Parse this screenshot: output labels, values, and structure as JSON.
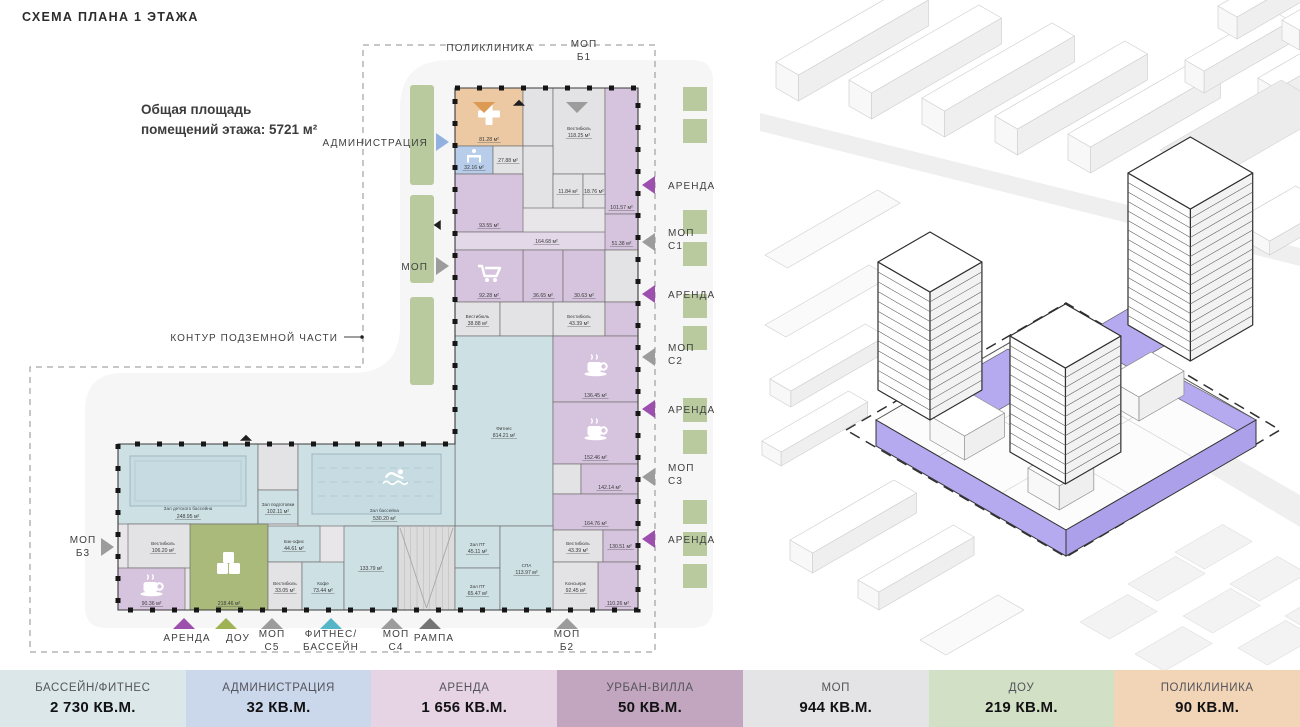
{
  "header": {
    "title": "СХЕМА ПЛАНА 1 ЭТАЖА"
  },
  "annotation": {
    "line1": "Общая площадь",
    "line2": "помещений этажа: 5721 м²"
  },
  "colors": {
    "plot": "#f6f6f6",
    "greenery": "#b9ca9e",
    "wall": "#3a3a3a",
    "rent": "#d6c4de",
    "rentc": "#e2d8e8",
    "mop": "#e3e2e4",
    "pool": "#cde0e4",
    "pool_water": "#c6dce2",
    "clinic": "#ecc9a2",
    "admin": "#b7cde9",
    "dou": "#a9ba7b",
    "ramp": "#dcdcdc",
    "iso_highlight": "#b5a9ef",
    "iso_highlight_dark": "#aca0ea",
    "arrow_orange": "#dc9a52",
    "arrow_gray": "#9c9c9c",
    "arrow_darkgray": "#757575",
    "arrow_purple": "#9d4fae",
    "arrow_blue": "#93b1e0",
    "arrow_green": "#9fb355",
    "arrow_teal": "#55b6c8",
    "arrow_black": "#1f1f1f"
  },
  "plan": {
    "contour": {
      "label": "КОНТУР ПОДЗЕМНОЙ ЧАСТИ",
      "tx": 338,
      "ty": 341,
      "line": [
        344,
        337,
        360,
        337
      ],
      "dot": [
        362,
        337
      ]
    },
    "rooms": [
      {
        "cat": "clinic",
        "r": [
          455,
          88,
          68,
          58
        ],
        "icon": "cross",
        "area": "81.28 м²"
      },
      {
        "cat": "mop",
        "r": [
          523,
          88,
          30,
          58
        ]
      },
      {
        "cat": "mop",
        "r": [
          553,
          88,
          52,
          86
        ],
        "name": "Вестибюль",
        "area": "118.25 м²"
      },
      {
        "cat": "rent",
        "r": [
          605,
          88,
          33,
          126
        ],
        "icon": "ruble",
        "area": "101.57 м²"
      },
      {
        "cat": "admin",
        "r": [
          455,
          146,
          38,
          28
        ],
        "icon": "desk",
        "area": "32.16 м²"
      },
      {
        "cat": "mop",
        "r": [
          493,
          146,
          30,
          28
        ],
        "area": "27.88 м²"
      },
      {
        "cat": "mop",
        "r": [
          523,
          146,
          30,
          62
        ]
      },
      {
        "cat": "mop",
        "r": [
          553,
          174,
          30,
          34
        ],
        "area": "11.84 м²"
      },
      {
        "cat": "mop",
        "r": [
          583,
          174,
          22,
          34
        ],
        "area": "18.76 м²"
      },
      {
        "cat": "rent",
        "r": [
          455,
          174,
          68,
          58
        ],
        "icon": "ruble",
        "area": "93.55 м²"
      },
      {
        "cat": "rentc",
        "r": [
          455,
          232,
          183,
          18
        ],
        "area": "164.68 м²"
      },
      {
        "cat": "rent",
        "r": [
          523,
          250,
          40,
          52
        ],
        "icon": "ruble",
        "area": "36.65 м²"
      },
      {
        "cat": "rent",
        "r": [
          563,
          250,
          42,
          52
        ],
        "icon": "ruble",
        "area": "30.63 м²"
      },
      {
        "cat": "rent",
        "r": [
          605,
          214,
          33,
          36
        ],
        "icon": "ruble",
        "area": "51.38 м²"
      },
      {
        "cat": "mop",
        "r": [
          605,
          250,
          33,
          52
        ]
      },
      {
        "cat": "rent",
        "r": [
          455,
          250,
          68,
          52
        ],
        "icon": "cart",
        "area": "92.28 м²"
      },
      {
        "cat": "mop",
        "r": [
          553,
          302,
          52,
          34
        ],
        "name": "Вестибюль",
        "area": "43.39 м²"
      },
      {
        "cat": "rent",
        "r": [
          605,
          302,
          33,
          34
        ]
      },
      {
        "cat": "mop",
        "r": [
          455,
          302,
          45,
          34
        ],
        "name": "Вестибюль",
        "area": "38.88 м²"
      },
      {
        "cat": "mop",
        "r": [
          500,
          302,
          53,
          34
        ]
      },
      {
        "cat": "pool",
        "r": [
          455,
          336,
          98,
          190
        ],
        "name": "Фитнес",
        "area": "814.21 м²"
      },
      {
        "cat": "rent",
        "r": [
          553,
          336,
          85,
          66
        ],
        "icon": "coffee",
        "area": "136.45 м²"
      },
      {
        "cat": "rent",
        "r": [
          553,
          402,
          85,
          62
        ],
        "icon": "coffee",
        "area": "152.46 м²"
      },
      {
        "cat": "mop",
        "r": [
          553,
          464,
          28,
          30
        ]
      },
      {
        "cat": "rent",
        "r": [
          581,
          464,
          57,
          30
        ],
        "icon": "ruble",
        "area": "142.14 м²"
      },
      {
        "cat": "rent",
        "r": [
          553,
          494,
          85,
          36
        ],
        "icon": "ruble",
        "area": "164.76 м²"
      },
      {
        "cat": "mop",
        "r": [
          553,
          530,
          50,
          32
        ],
        "name": "Вестибюль",
        "area": "43.39 м²"
      },
      {
        "cat": "rent",
        "r": [
          603,
          530,
          35,
          32
        ],
        "area": "130.51 м²"
      },
      {
        "cat": "rent",
        "r": [
          598,
          562,
          40,
          48
        ],
        "icon": "ruble",
        "area": "110.26 м²"
      },
      {
        "cat": "mop",
        "r": [
          553,
          562,
          45,
          48
        ],
        "name": "Консьерж",
        "area": "92.45 м²"
      },
      {
        "cat": "pool",
        "r": [
          118,
          444,
          140,
          80
        ],
        "name": "Зал детского бассейна",
        "area": "248.95 м²",
        "feature": "kidspool"
      },
      {
        "cat": "mop",
        "r": [
          258,
          444,
          40,
          46
        ]
      },
      {
        "cat": "pool",
        "r": [
          258,
          490,
          40,
          34
        ],
        "name": "Зал подготовки",
        "area": "102.11 м²"
      },
      {
        "cat": "pool",
        "r": [
          298,
          444,
          157,
          82
        ],
        "name": "Зал бассейна",
        "area": "530.20 м²",
        "feature": "pool"
      },
      {
        "cat": "mop",
        "r": [
          128,
          524,
          70,
          44
        ],
        "name": "Вестибюль",
        "area": "106.20 м²"
      },
      {
        "cat": "rent",
        "r": [
          118,
          568,
          67,
          42
        ],
        "icon": "coffee",
        "area": "90.36 м²"
      },
      {
        "cat": "dou",
        "r": [
          190,
          524,
          78,
          86
        ],
        "icon": "blocks",
        "area": "218.46 м²"
      },
      {
        "cat": "pool",
        "r": [
          268,
          526,
          52,
          36
        ],
        "name": "Бэк-офис",
        "area": "44.61 м²"
      },
      {
        "cat": "mop",
        "r": [
          268,
          562,
          34,
          48
        ],
        "name": "Вестибюль",
        "area": "33.05 м²"
      },
      {
        "cat": "pool",
        "r": [
          302,
          562,
          42,
          48
        ],
        "name": "Кофе",
        "area": "73.44 м²"
      },
      {
        "cat": "pool",
        "r": [
          344,
          526,
          54,
          84
        ],
        "area": "133.79 м²"
      },
      {
        "cat": "ramp",
        "r": [
          398,
          526,
          57,
          84
        ],
        "feature": "ramp"
      },
      {
        "cat": "pool",
        "r": [
          455,
          526,
          45,
          42
        ],
        "name": "Зал ПТ",
        "area": "45.11 м²"
      },
      {
        "cat": "pool",
        "r": [
          455,
          568,
          45,
          42
        ],
        "name": "Зал ПТ",
        "area": "65.47 м²"
      },
      {
        "cat": "pool",
        "r": [
          500,
          526,
          53,
          84
        ],
        "name": "СПА",
        "area": "113.97 м²"
      }
    ],
    "callouts": [
      {
        "side": "top",
        "lines": [
          "ПОЛИКЛИНИКА"
        ],
        "tx": 490,
        "ty": 51,
        "tri": [
          484,
          107,
          "down",
          "orange"
        ]
      },
      {
        "side": "top",
        "lines": [
          "МОП",
          "Б1"
        ],
        "tx": 584,
        "ty": 47,
        "tri": [
          577,
          107,
          "down",
          "gray"
        ]
      },
      {
        "side": "right",
        "lines": [
          "АРЕНДА"
        ],
        "tx": 668,
        "ty": 189,
        "tri": [
          650,
          185,
          "left",
          "purple"
        ]
      },
      {
        "side": "right",
        "lines": [
          "МОП",
          "С1"
        ],
        "tx": 668,
        "ty": 236,
        "tri": [
          650,
          242,
          "left",
          "gray"
        ]
      },
      {
        "side": "right",
        "lines": [
          "АРЕНДА"
        ],
        "tx": 668,
        "ty": 298,
        "tri": [
          650,
          294,
          "left",
          "purple"
        ]
      },
      {
        "side": "right",
        "lines": [
          "МОП",
          "С2"
        ],
        "tx": 668,
        "ty": 351,
        "tri": [
          650,
          357,
          "left",
          "gray"
        ]
      },
      {
        "side": "right",
        "lines": [
          "АРЕНДА"
        ],
        "tx": 668,
        "ty": 413,
        "tri": [
          650,
          409,
          "left",
          "purple"
        ]
      },
      {
        "side": "right",
        "lines": [
          "МОП",
          "С3"
        ],
        "tx": 668,
        "ty": 471,
        "tri": [
          650,
          477,
          "left",
          "gray"
        ]
      },
      {
        "side": "right",
        "lines": [
          "АРЕНДА"
        ],
        "tx": 668,
        "ty": 543,
        "tri": [
          650,
          539,
          "left",
          "purple"
        ]
      },
      {
        "side": "left",
        "lines": [
          "АДМИНИСТРАЦИЯ"
        ],
        "tx": 428,
        "ty": 146,
        "tri": [
          441,
          142,
          "right",
          "blue"
        ]
      },
      {
        "side": "left",
        "lines": [
          "МОП"
        ],
        "tx": 428,
        "ty": 270,
        "tri": [
          441,
          266,
          "right",
          "gray"
        ]
      },
      {
        "side": "leftm",
        "lines": [
          "МОП",
          "Б3"
        ],
        "tx": 83,
        "ty": 543,
        "tri": [
          106,
          547,
          "right",
          "gray"
        ]
      },
      {
        "side": "bottom",
        "lines": [
          "АРЕНДА"
        ],
        "tx": 187,
        "ty": 641,
        "tri": [
          184,
          624,
          "up",
          "purple"
        ]
      },
      {
        "side": "bottom",
        "lines": [
          "ДОУ"
        ],
        "tx": 238,
        "ty": 641,
        "tri": [
          226,
          624,
          "up",
          "green"
        ]
      },
      {
        "side": "bottom",
        "lines": [
          "МОП",
          "С5"
        ],
        "tx": 272,
        "ty": 637,
        "tri": [
          272,
          624,
          "up",
          "gray"
        ]
      },
      {
        "side": "bottom",
        "lines": [
          "ФИТНЕС/",
          "БАССЕЙН"
        ],
        "tx": 331,
        "ty": 637,
        "tri": [
          331,
          624,
          "up",
          "teal"
        ]
      },
      {
        "side": "bottom",
        "lines": [
          "МОП",
          "С4"
        ],
        "tx": 396,
        "ty": 637,
        "tri": [
          392,
          624,
          "up",
          "gray"
        ]
      },
      {
        "side": "bottom",
        "lines": [
          "РАМПА"
        ],
        "tx": 434,
        "ty": 641,
        "tri": [
          430,
          624,
          "up",
          "darkgray"
        ]
      },
      {
        "side": "bottom",
        "lines": [
          "МОП",
          "Б2"
        ],
        "tx": 567,
        "ty": 637,
        "tri": [
          567,
          624,
          "up",
          "gray"
        ]
      }
    ],
    "marks": [
      [
        519,
        103,
        "up",
        "black"
      ],
      [
        246,
        438,
        "up",
        "black"
      ],
      [
        438,
        225,
        "left",
        "black"
      ]
    ]
  },
  "legend": {
    "items": [
      {
        "label": "БАССЕЙН/ФИТНЕС",
        "value": "2 730 КВ.М.",
        "color": "#dbe7e8"
      },
      {
        "label": "АДМИНИСТРАЦИЯ",
        "value": "32 КВ.М.",
        "color": "#cbd7ea"
      },
      {
        "label": "АРЕНДА",
        "value": "1 656 КВ.М.",
        "color": "#e6d3e3"
      },
      {
        "label": "УРБАН-ВИЛЛА",
        "value": "50 КВ.М.",
        "color": "#c2a5be"
      },
      {
        "label": "МОП",
        "value": "944 КВ.М.",
        "color": "#e4e4e6"
      },
      {
        "label": "ДОУ",
        "value": "219 КВ.М.",
        "color": "#d2e0c5"
      },
      {
        "label": "ПОЛИКЛИНИКА",
        "value": "90 КВ.М.",
        "color": "#f2d5b7"
      }
    ]
  }
}
